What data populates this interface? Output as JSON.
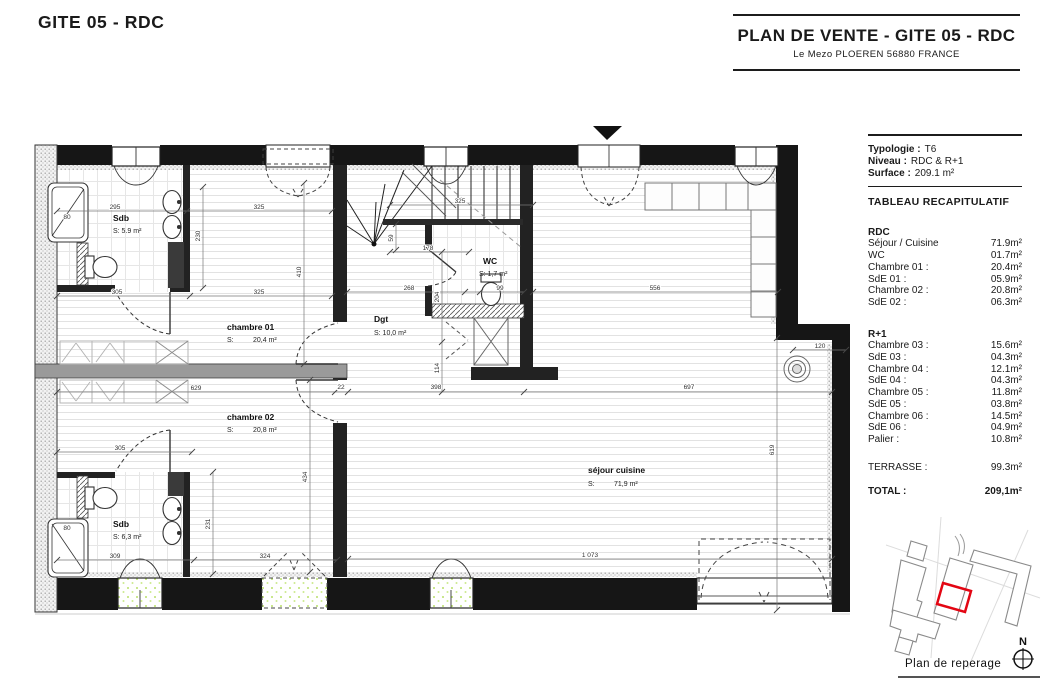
{
  "page_title": "GITE 05 - RDC",
  "header": {
    "title": "PLAN DE VENTE - GITE 05 - RDC",
    "subtitle": "Le Mezo PLOEREN 56880 FRANCE"
  },
  "info": {
    "typologie_label": "Typologie :",
    "typologie_value": "T6",
    "niveau_label": "Niveau :",
    "niveau_value": "RDC & R+1",
    "surface_label": "Surface :",
    "surface_value": "209.1 m²",
    "table_title": "TABLEAU RECAPITULATIF",
    "sections": [
      {
        "name": "RDC",
        "rows": [
          [
            "Séjour / Cuisine",
            "71.9m²"
          ],
          [
            "WC",
            "01.7m²"
          ],
          [
            "Chambre 01 :",
            "20.4m²"
          ],
          [
            "SdE 01 :",
            "05.9m²"
          ],
          [
            "Chambre 02 :",
            "20.8m²"
          ],
          [
            "SdE 02 :",
            "06.3m²"
          ]
        ]
      },
      {
        "name": "R+1",
        "rows": [
          [
            "Chambre 03 :",
            "15.6m²"
          ],
          [
            "SdE 03 :",
            "04.3m²"
          ],
          [
            "Chambre 04 :",
            "12.1m²"
          ],
          [
            "SdE 04 :",
            "04.3m²"
          ],
          [
            "Chambre 05 :",
            "11.8m²"
          ],
          [
            "SdE 05 :",
            "03.8m²"
          ],
          [
            "Chambre 06 :",
            "14.5m²"
          ],
          [
            "SdE 06 :",
            "04.9m²"
          ],
          [
            "Palier :",
            "10.8m²"
          ]
        ]
      }
    ],
    "terrasse_label": "TERRASSE :",
    "terrasse_value": "99.3m²",
    "total_label": "TOTAL :",
    "total_value": "209,1m²"
  },
  "plan": {
    "rooms": [
      {
        "n": "Sdb",
        "a": "S: 5.9 m²",
        "x": 113,
        "y": 221,
        "ax": 113,
        "ay": 233
      },
      {
        "n": "chambre 01",
        "s": "20,4 m²",
        "x": 227,
        "y": 330,
        "ax": 227,
        "ay": 342
      },
      {
        "n": "Dgt",
        "a": "S: 10,0 m²",
        "x": 374,
        "y": 322,
        "ax": 374,
        "ay": 335
      },
      {
        "n": "WC",
        "a": "S: 1,7 m²",
        "x": 483,
        "y": 264,
        "ax": 479,
        "ay": 276
      },
      {
        "n": "séjour cuisine",
        "s": "71,9 m²",
        "x": 588,
        "y": 473,
        "ax": 588,
        "ay": 486
      },
      {
        "n": "chambre 02",
        "s": "20,8 m²",
        "x": 227,
        "y": 420,
        "ax": 227,
        "ay": 432
      },
      {
        "n": "Sdb",
        "a": "S: 6,3 m²",
        "x": 113,
        "y": 527,
        "ax": 113,
        "ay": 539
      }
    ],
    "dims": [
      {
        "t": "295",
        "x": 115,
        "y": 209
      },
      {
        "t": "325",
        "x": 259,
        "y": 209
      },
      {
        "t": "325",
        "x": 460,
        "y": 203
      },
      {
        "t": "305",
        "x": 117,
        "y": 294
      },
      {
        "t": "325",
        "x": 259,
        "y": 294
      },
      {
        "t": "178",
        "x": 428,
        "y": 250
      },
      {
        "t": "268",
        "x": 409,
        "y": 290
      },
      {
        "t": "99",
        "x": 500,
        "y": 290
      },
      {
        "t": "556",
        "x": 655,
        "y": 290
      },
      {
        "t": "629",
        "x": 196,
        "y": 390
      },
      {
        "t": "22",
        "x": 341,
        "y": 389
      },
      {
        "t": "398",
        "x": 436,
        "y": 389
      },
      {
        "t": "697",
        "x": 689,
        "y": 389
      },
      {
        "t": "305",
        "x": 120,
        "y": 450
      },
      {
        "t": "309",
        "x": 115,
        "y": 558
      },
      {
        "t": "324",
        "x": 265,
        "y": 558
      },
      {
        "t": "1 073",
        "x": 590,
        "y": 557
      },
      {
        "t": "120",
        "x": 820,
        "y": 348
      },
      {
        "t": "80",
        "x": 67,
        "y": 219
      },
      {
        "t": "80",
        "x": 67,
        "y": 530
      },
      {
        "t": "230",
        "x": 200,
        "y": 236,
        "r": 1
      },
      {
        "t": "410",
        "x": 301,
        "y": 272,
        "r": 1
      },
      {
        "t": "59",
        "x": 393,
        "y": 238,
        "r": 1
      },
      {
        "t": "204",
        "x": 439,
        "y": 297,
        "r": 1
      },
      {
        "t": "114",
        "x": 439,
        "y": 368,
        "r": 1
      },
      {
        "t": "434",
        "x": 307,
        "y": 477,
        "r": 1
      },
      {
        "t": "231",
        "x": 210,
        "y": 524,
        "r": 1
      },
      {
        "t": "619",
        "x": 774,
        "y": 450,
        "r": 1
      }
    ]
  },
  "reperage": {
    "label": "Plan de reperage",
    "north_label": "N",
    "highlight_color": "#e30613"
  }
}
